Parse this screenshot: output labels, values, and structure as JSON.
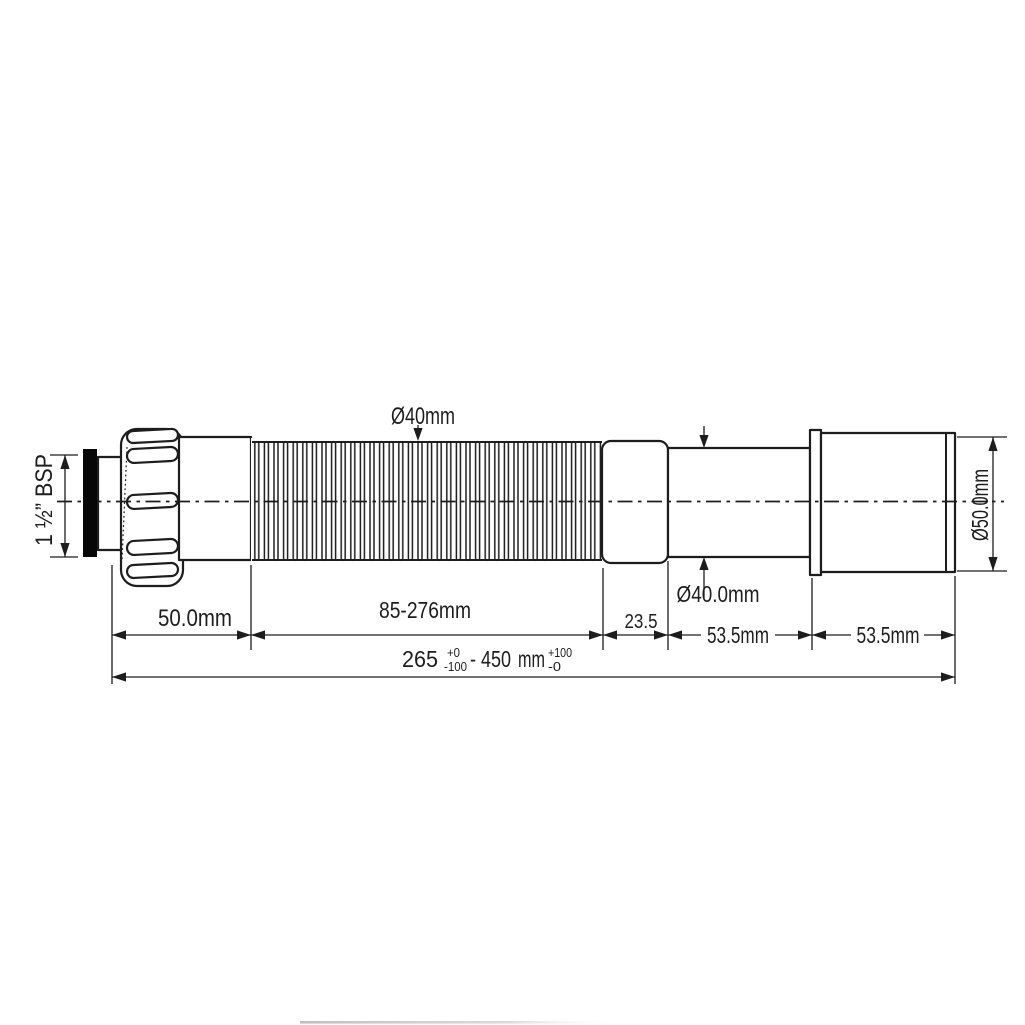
{
  "labels": {
    "top_diameter": "Ø40mm",
    "thread_size": "1 ½” BSP",
    "nut_length": "50.0mm",
    "hose_length": "85-276mm",
    "collar_length": "23.5",
    "tube_length": "53.5mm",
    "sleeve_length": "53.5mm",
    "tube_diameter": "Ø40.0mm",
    "sleeve_diameter": "Ø50.0mm"
  },
  "overall_dimension": {
    "min_value": "265",
    "min_tolerance_plus": "+0",
    "min_tolerance_minus": "-100",
    "to_max_value": "- 450",
    "unit": "mm",
    "max_tolerance_plus": "+100",
    "max_tolerance_minus": "-0"
  },
  "colors": {
    "line": "#1d1d1d",
    "washer": "#070707",
    "background": "#ffffff"
  }
}
